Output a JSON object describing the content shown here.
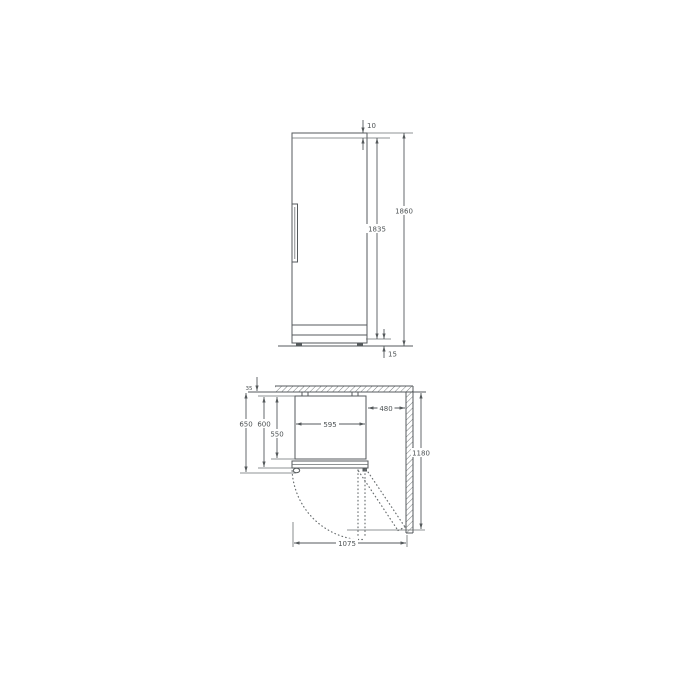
{
  "drawing": {
    "type": "appliance installation dimension drawing",
    "colors": {
      "line": "#555a5c",
      "text": "#4d5254",
      "background": "#ffffff"
    }
  },
  "front_view": {
    "top_clearance": "10",
    "total_height": "1860",
    "door_height": "1835",
    "floor_clearance": "15"
  },
  "plan_view": {
    "rear_clearance": "35",
    "depth_overall": "650",
    "depth_with_door": "600",
    "body_depth": "550",
    "appliance_width": "595",
    "side_clearance": "480",
    "depth_door_open": "1180",
    "width_door_open": "1075"
  }
}
